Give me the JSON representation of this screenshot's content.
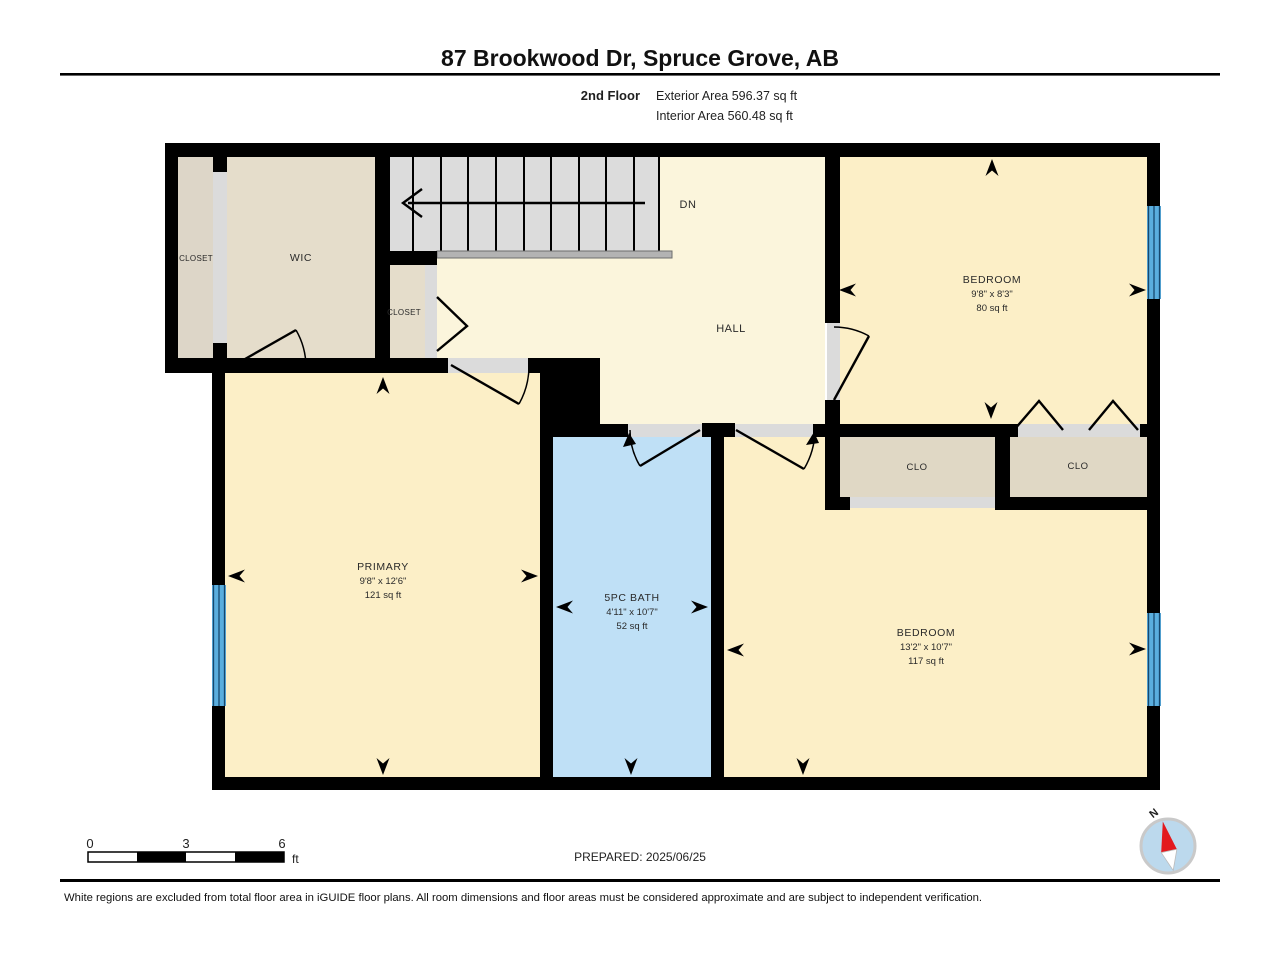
{
  "header": {
    "title": "87 Brookwood Dr, Spruce Grove, AB",
    "floor_label": "2nd Floor",
    "exterior_area": "Exterior Area 596.37 sq ft",
    "interior_area": "Interior Area 560.48 sq ft"
  },
  "plan": {
    "stairs": {
      "direction_label": "DN"
    },
    "rooms": {
      "closet_left": {
        "name": "CLOSET"
      },
      "wic": {
        "name": "WIC"
      },
      "closet_hall": {
        "name": "CLOSET"
      },
      "hall": {
        "name": "HALL"
      },
      "bedroom_top": {
        "name": "BEDROOM",
        "dimensions": "9'8\" x 8'3\"",
        "area": "80 sq ft"
      },
      "clo_left": {
        "name": "CLO"
      },
      "clo_right": {
        "name": "CLO"
      },
      "primary": {
        "name": "PRIMARY",
        "dimensions": "9'8\" x 12'6\"",
        "area": "121 sq ft"
      },
      "bath": {
        "name": "5PC BATH",
        "dimensions": "4'11\" x 10'7\"",
        "area": "52 sq ft"
      },
      "bedroom_bottom": {
        "name": "BEDROOM",
        "dimensions": "13'2\" x 10'7\"",
        "area": "117 sq ft"
      }
    }
  },
  "footer": {
    "scale_bar": {
      "tick_0": "0",
      "tick_3": "3",
      "tick_6": "6",
      "unit": "ft"
    },
    "prepared": "PREPARED: 2025/06/25",
    "compass": {
      "north_label": "N"
    },
    "disclaimer": "White regions are excluded from total floor area in iGUIDE floor plans. All room dimensions and floor areas must be considered approximate and are subject to independent verification."
  },
  "colors": {
    "room_yellow": "#FCEFC7",
    "hall_cream": "#FBF5DC",
    "closet_tan": "#E5DDCB",
    "clo_tan": "#E0D8C5",
    "bath_blue": "#BFE0F6",
    "floor_gray": "#DBDBDB",
    "window_blue": "#5AAEDE",
    "wall_black": "#000000",
    "compass_red": "#E3191E"
  }
}
